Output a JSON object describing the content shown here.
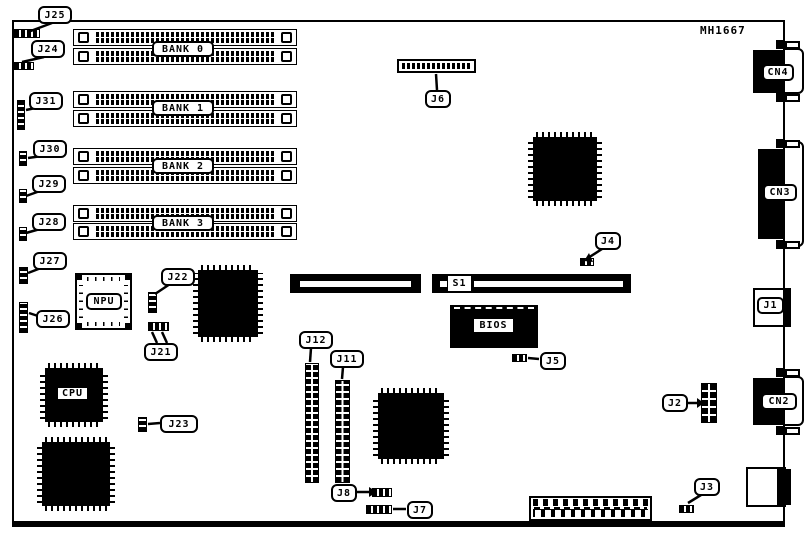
{
  "board": {
    "part_number": "MH1667",
    "memory_banks": [
      {
        "label": "BANK 0"
      },
      {
        "label": "BANK 1"
      },
      {
        "label": "BANK 2"
      },
      {
        "label": "BANK 3"
      }
    ],
    "chips": {
      "npu": "NPU",
      "cpu": "CPU",
      "bios": "BIOS"
    },
    "dip_switch": "S1",
    "jumpers": {
      "j2": "J2",
      "j3": "J3",
      "j4": "J4",
      "j5": "J5",
      "j6": "J6",
      "j7": "J7",
      "j8": "J8",
      "j11": "J11",
      "j12": "J12",
      "j21": "J21",
      "j22": "J22",
      "j23": "J23",
      "j24": "J24",
      "j25": "J25",
      "j26": "J26",
      "j27": "J27",
      "j28": "J28",
      "j29": "J29",
      "j30": "J30",
      "j31": "J31"
    },
    "connectors": {
      "j1": "J1",
      "cn2": "CN2",
      "cn3": "CN3",
      "cn4": "CN4"
    },
    "colors": {
      "ink": "#000000",
      "background": "#ffffff"
    }
  }
}
